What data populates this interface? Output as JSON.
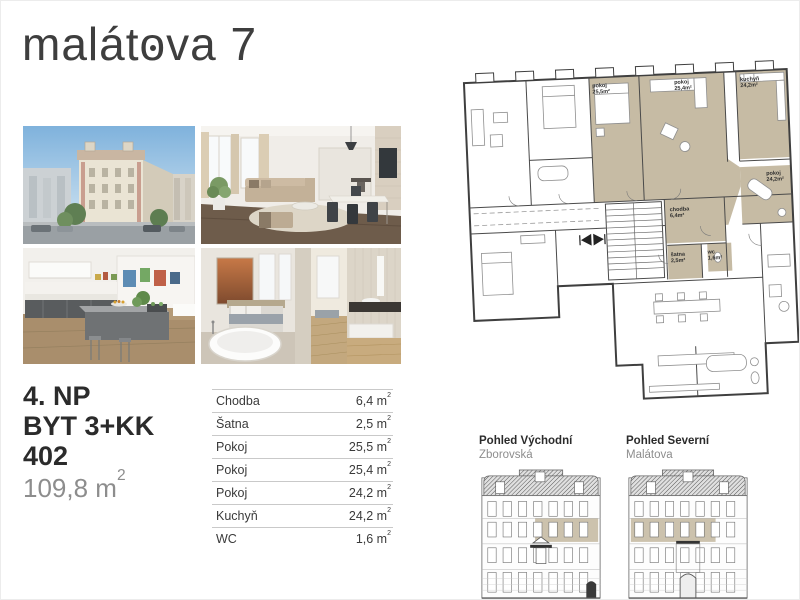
{
  "brand": {
    "title_pre": "malát",
    "title_o": "o",
    "title_post": "va 7"
  },
  "unit": {
    "floor": "4. NP",
    "layout": "BYT 3+KK",
    "number": "402",
    "area": "109,8 m",
    "area_sup": "2"
  },
  "rooms": {
    "sup": "2",
    "items": [
      {
        "name": "Chodba",
        "area": "6,4 m"
      },
      {
        "name": "Šatna",
        "area": "2,5 m"
      },
      {
        "name": "Pokoj",
        "area": "25,5 m"
      },
      {
        "name": "Pokoj",
        "area": "25,4 m"
      },
      {
        "name": "Pokoj",
        "area": "24,2 m"
      },
      {
        "name": "Kuchyň",
        "area": "24,2 m"
      },
      {
        "name": "WC",
        "area": "1,6 m"
      }
    ]
  },
  "plan": {
    "labels": [
      {
        "name": "pokoj",
        "area": "25,5m²"
      },
      {
        "name": "pokoj",
        "area": "25,4m²"
      },
      {
        "name": "kuchyň",
        "area": "24,2m²"
      },
      {
        "name": "pokoj",
        "area": "24,2m²"
      },
      {
        "name": "chodba",
        "area": "6,4m²"
      },
      {
        "name": "šatna",
        "area": "2,5m²"
      },
      {
        "name": "wc",
        "area": "1,6m²"
      }
    ]
  },
  "elevations": {
    "items": [
      {
        "title": "Pohled Východní",
        "subtitle": "Zborovská"
      },
      {
        "title": "Pohled Severní",
        "subtitle": "Malátova"
      }
    ]
  },
  "colors": {
    "highlight": "#c6bba4",
    "accent_dark": "#3e3e3e",
    "muted": "#8d8d8d",
    "rule": "#c9c9c9"
  }
}
